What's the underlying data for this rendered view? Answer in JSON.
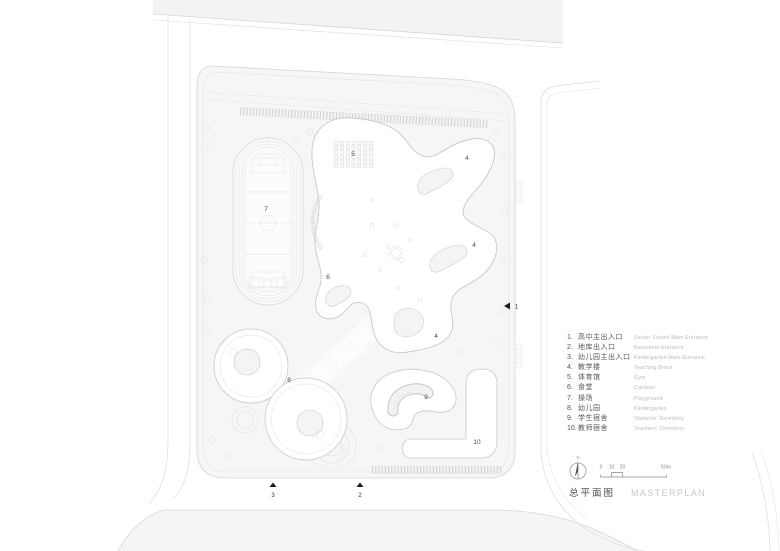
{
  "legend": {
    "items": [
      {
        "num": "1.",
        "zh": "高中主出入口",
        "en": "Senior School Main Entrance"
      },
      {
        "num": "2.",
        "zh": "地库出入口",
        "en": "Basement Entrance"
      },
      {
        "num": "3.",
        "zh": "幼儿园主出入口",
        "en": "Kindergarten Main Entrance"
      },
      {
        "num": "4.",
        "zh": "教学楼",
        "en": "Teaching Block"
      },
      {
        "num": "5.",
        "zh": "体育馆",
        "en": "Gym"
      },
      {
        "num": "6.",
        "zh": "食堂",
        "en": "Canteen"
      },
      {
        "num": "7.",
        "zh": "操场",
        "en": "Playground"
      },
      {
        "num": "8.",
        "zh": "幼儿园",
        "en": "Kindergarten"
      },
      {
        "num": "9.",
        "zh": "学生宿舍",
        "en": "Students' Dormitory"
      },
      {
        "num": "10.",
        "zh": "教师宿舍",
        "en": "Teachers' Dormitory"
      }
    ]
  },
  "plan": {
    "labels": [
      {
        "id": "5"
      },
      {
        "id": "7"
      },
      {
        "id": "4"
      },
      {
        "id": "4"
      },
      {
        "id": "4"
      },
      {
        "id": "6"
      },
      {
        "id": "8"
      },
      {
        "id": "9"
      },
      {
        "id": "10"
      }
    ],
    "entrances": [
      {
        "num": "1"
      },
      {
        "num": "2"
      },
      {
        "num": "3"
      }
    ]
  },
  "titleblock": {
    "north_label": "N",
    "scale_ticks": [
      "0",
      "10",
      "20",
      "50m"
    ],
    "title_zh": "总平面图",
    "title_en": "MASTERPLAN"
  },
  "colors": {
    "ground": "#f6f6f6",
    "road_fill": "#f3f3f3",
    "line_light": "#d9d9d9",
    "building_outline": "#c8c8c8",
    "label_text": "#4a4a4a",
    "legend_en": "#b9b9b9",
    "marker_black": "#1b1b1b"
  }
}
